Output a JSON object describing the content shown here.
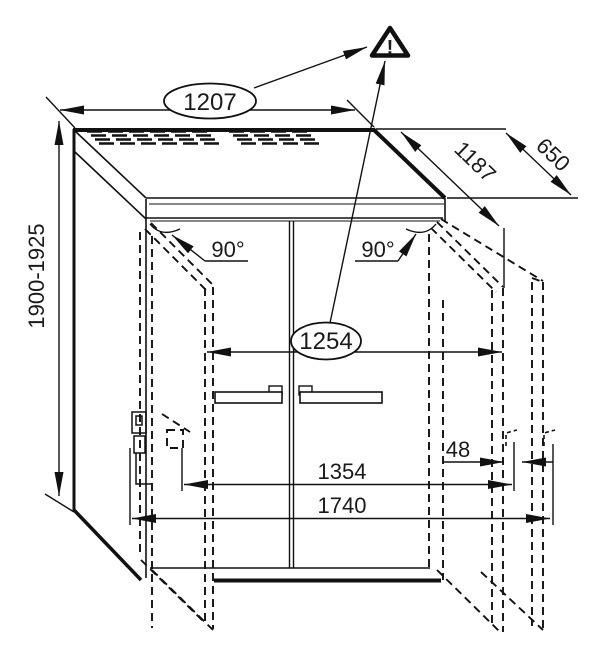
{
  "figure": {
    "type": "technical-drawing",
    "subject": "Appliance installation drawing: cabinet with two doors shown open 90 degrees, with overall dimensions",
    "units": "mm",
    "dimensions": {
      "top_width": "1207",
      "depth_with_door": "1187",
      "depth": "650",
      "height_range": "1900-1925",
      "door_angle_left": "90°",
      "door_angle_right": "90°",
      "circled_width": "1254",
      "hinge_clearance": "48",
      "width_doors_open": "1354",
      "overall_width_doors_open": "1740"
    },
    "icons": {
      "warning_glyph": "!"
    }
  }
}
